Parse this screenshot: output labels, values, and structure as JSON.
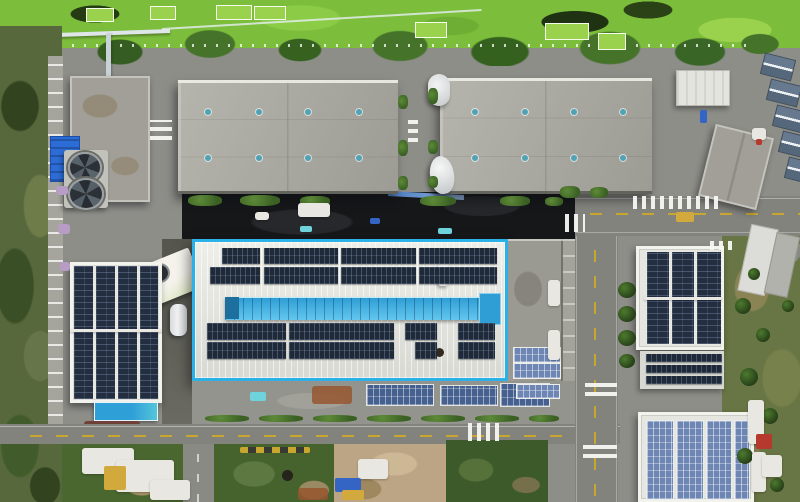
{
  "scene": {
    "type": "aerial-drone-photo",
    "subject": "industrial park with rooftop solar arrays, central plant outlined in cyan",
    "palette": {
      "pond_green": "#7cbd3c",
      "algae_green": "#9ad24e",
      "tree_green": "#3f6b28",
      "scrub_green": "#4a672f",
      "field_olive": "#687544",
      "dirt_tan": "#bca584",
      "pavement": "#8e8e89",
      "road": "#83837e",
      "asphalt_dark": "#151719",
      "warehouse_roof": "#aaaaa2",
      "roof_white": "#e7e7e2",
      "highlight_cyan": "#2ab2e8",
      "skylight_blue": "#3fa9dc",
      "solar_dark": "#1f2937",
      "solar_mid": "#46618f",
      "solar_light": "#6d86b4",
      "panel_column": "#232e40",
      "tarp_blue": "#2c6cd6",
      "canopy_blue": "#2f9fd8",
      "lane_yellow": "#c9a72e",
      "vent_teal": "#4fa3b5",
      "cabin_gray_blue": "#66798e"
    }
  },
  "elements": [
    {
      "name": "sports-court",
      "cls": "court",
      "x": 86,
      "y": 8,
      "w": 26,
      "h": 12
    },
    {
      "name": "sports-court",
      "cls": "court",
      "x": 150,
      "y": 6,
      "w": 24,
      "h": 12
    },
    {
      "name": "sports-court",
      "cls": "court",
      "x": 216,
      "y": 5,
      "w": 34,
      "h": 13
    },
    {
      "name": "sports-court",
      "cls": "court",
      "x": 254,
      "y": 6,
      "w": 30,
      "h": 12
    },
    {
      "name": "sports-court",
      "cls": "court",
      "x": 415,
      "y": 22,
      "w": 30,
      "h": 14
    },
    {
      "name": "sports-court",
      "cls": "court",
      "x": 545,
      "y": 23,
      "w": 42,
      "h": 15
    },
    {
      "name": "sports-court",
      "cls": "court",
      "x": 598,
      "y": 33,
      "w": 26,
      "h": 15
    },
    {
      "name": "roof-vent",
      "cls": "vent",
      "x": 205,
      "y": 109,
      "w": 6,
      "h": 6
    },
    {
      "name": "roof-vent",
      "cls": "vent",
      "x": 256,
      "y": 109,
      "w": 6,
      "h": 6
    },
    {
      "name": "roof-vent",
      "cls": "vent",
      "x": 305,
      "y": 109,
      "w": 6,
      "h": 6
    },
    {
      "name": "roof-vent",
      "cls": "vent",
      "x": 356,
      "y": 109,
      "w": 6,
      "h": 6
    },
    {
      "name": "roof-vent",
      "cls": "vent",
      "x": 205,
      "y": 155,
      "w": 6,
      "h": 6
    },
    {
      "name": "roof-vent",
      "cls": "vent",
      "x": 256,
      "y": 155,
      "w": 6,
      "h": 6
    },
    {
      "name": "roof-vent",
      "cls": "vent",
      "x": 305,
      "y": 155,
      "w": 6,
      "h": 6
    },
    {
      "name": "roof-vent",
      "cls": "vent",
      "x": 356,
      "y": 155,
      "w": 6,
      "h": 6
    },
    {
      "name": "roof-vent",
      "cls": "vent",
      "x": 472,
      "y": 109,
      "w": 6,
      "h": 6
    },
    {
      "name": "roof-vent",
      "cls": "vent",
      "x": 522,
      "y": 109,
      "w": 6,
      "h": 6
    },
    {
      "name": "roof-vent",
      "cls": "vent",
      "x": 571,
      "y": 109,
      "w": 6,
      "h": 6
    },
    {
      "name": "roof-vent",
      "cls": "vent",
      "x": 620,
      "y": 109,
      "w": 6,
      "h": 6
    },
    {
      "name": "roof-vent",
      "cls": "vent",
      "x": 472,
      "y": 155,
      "w": 6,
      "h": 6
    },
    {
      "name": "roof-vent",
      "cls": "vent",
      "x": 522,
      "y": 155,
      "w": 6,
      "h": 6
    },
    {
      "name": "roof-vent",
      "cls": "vent",
      "x": 571,
      "y": 155,
      "w": 6,
      "h": 6
    },
    {
      "name": "roof-vent",
      "cls": "vent",
      "x": 620,
      "y": 155,
      "w": 6,
      "h": 6
    },
    {
      "name": "rooftop-solar-array",
      "cls": "solar-dark",
      "x": 222,
      "y": 248,
      "w": 38,
      "h": 16
    },
    {
      "name": "rooftop-solar-array",
      "cls": "solar-dark",
      "x": 264,
      "y": 248,
      "w": 74,
      "h": 16
    },
    {
      "name": "rooftop-solar-array",
      "cls": "solar-dark",
      "x": 341,
      "y": 248,
      "w": 75,
      "h": 16
    },
    {
      "name": "rooftop-solar-array",
      "cls": "solar-dark",
      "x": 419,
      "y": 248,
      "w": 78,
      "h": 16
    },
    {
      "name": "rooftop-solar-array",
      "cls": "solar-dark",
      "x": 210,
      "y": 267,
      "w": 50,
      "h": 17
    },
    {
      "name": "rooftop-solar-array",
      "cls": "solar-dark",
      "x": 264,
      "y": 267,
      "w": 74,
      "h": 17
    },
    {
      "name": "rooftop-solar-array",
      "cls": "solar-dark",
      "x": 341,
      "y": 267,
      "w": 75,
      "h": 17
    },
    {
      "name": "rooftop-solar-array",
      "cls": "solar-dark",
      "x": 419,
      "y": 267,
      "w": 78,
      "h": 17
    },
    {
      "name": "rooftop-solar-array",
      "cls": "solar-dark",
      "x": 207,
      "y": 323,
      "w": 79,
      "h": 17
    },
    {
      "name": "rooftop-solar-array",
      "cls": "solar-dark",
      "x": 289,
      "y": 323,
      "w": 105,
      "h": 17
    },
    {
      "name": "rooftop-solar-array",
      "cls": "solar-dark",
      "x": 405,
      "y": 323,
      "w": 32,
      "h": 17
    },
    {
      "name": "rooftop-solar-array",
      "cls": "solar-dark",
      "x": 458,
      "y": 323,
      "w": 37,
      "h": 17
    },
    {
      "name": "rooftop-solar-array",
      "cls": "solar-dark",
      "x": 207,
      "y": 342,
      "w": 79,
      "h": 17
    },
    {
      "name": "rooftop-solar-array",
      "cls": "solar-dark",
      "x": 289,
      "y": 342,
      "w": 105,
      "h": 17
    },
    {
      "name": "rooftop-solar-array",
      "cls": "solar-dark",
      "x": 415,
      "y": 342,
      "w": 22,
      "h": 17
    },
    {
      "name": "rooftop-solar-array",
      "cls": "solar-dark",
      "x": 458,
      "y": 342,
      "w": 37,
      "h": 17
    },
    {
      "name": "solar-column",
      "cls": "solar-left",
      "x": 74,
      "y": 266,
      "w": 19,
      "h": 133
    },
    {
      "name": "solar-column",
      "cls": "solar-left",
      "x": 96,
      "y": 266,
      "w": 19,
      "h": 133
    },
    {
      "name": "solar-column",
      "cls": "solar-left",
      "x": 118,
      "y": 266,
      "w": 19,
      "h": 133
    },
    {
      "name": "solar-column",
      "cls": "solar-left",
      "x": 140,
      "y": 266,
      "w": 18,
      "h": 133
    },
    {
      "name": "roof-walkway",
      "cls": "clutter-white",
      "x": 70,
      "y": 329,
      "w": 92,
      "h": 3
    },
    {
      "name": "solar-column",
      "cls": "solar-left",
      "x": 647,
      "y": 252,
      "w": 22,
      "h": 92
    },
    {
      "name": "solar-column",
      "cls": "solar-left",
      "x": 672,
      "y": 252,
      "w": 22,
      "h": 92
    },
    {
      "name": "solar-column",
      "cls": "solar-left",
      "x": 697,
      "y": 252,
      "w": 24,
      "h": 92
    },
    {
      "name": "roof-walkway",
      "cls": "clutter-white",
      "x": 644,
      "y": 297,
      "w": 78,
      "h": 3
    },
    {
      "name": "solar-row",
      "cls": "solar-dark",
      "x": 646,
      "y": 354,
      "w": 76,
      "h": 8
    },
    {
      "name": "solar-row",
      "cls": "solar-dark",
      "x": 646,
      "y": 365,
      "w": 76,
      "h": 8
    },
    {
      "name": "solar-row",
      "cls": "solar-dark",
      "x": 646,
      "y": 376,
      "w": 76,
      "h": 8
    },
    {
      "name": "solar-column",
      "cls": "solar-light",
      "x": 646,
      "y": 420,
      "w": 26,
      "h": 78
    },
    {
      "name": "solar-column",
      "cls": "solar-light",
      "x": 676,
      "y": 420,
      "w": 26,
      "h": 78
    },
    {
      "name": "solar-column",
      "cls": "solar-light",
      "x": 706,
      "y": 420,
      "w": 24,
      "h": 78
    },
    {
      "name": "solar-column",
      "cls": "solar-light",
      "x": 734,
      "y": 420,
      "w": 14,
      "h": 78
    },
    {
      "name": "ground-solar-array",
      "cls": "solar-mid",
      "x": 366,
      "y": 384,
      "w": 66,
      "h": 20
    },
    {
      "name": "ground-solar-array",
      "cls": "solar-mid",
      "x": 440,
      "y": 385,
      "w": 56,
      "h": 19
    },
    {
      "name": "ground-solar-array",
      "cls": "solar-mid",
      "x": 500,
      "y": 383,
      "w": 48,
      "h": 22
    },
    {
      "name": "annex-solar-array",
      "cls": "solar-light",
      "x": 513,
      "y": 347,
      "w": 46,
      "h": 14
    },
    {
      "name": "annex-solar-array",
      "cls": "solar-light",
      "x": 513,
      "y": 363,
      "w": 46,
      "h": 14
    },
    {
      "name": "annex-solar-array",
      "cls": "solar-light",
      "x": 516,
      "y": 384,
      "w": 42,
      "h": 13
    },
    {
      "name": "crosswalk",
      "cls": "cw-v",
      "x": 633,
      "y": 196,
      "w": 86,
      "h": 13
    },
    {
      "name": "crosswalk",
      "cls": "cw-v",
      "x": 565,
      "y": 214,
      "w": 20,
      "h": 18
    },
    {
      "name": "crosswalk",
      "cls": "cw-h",
      "x": 150,
      "y": 120,
      "w": 22,
      "h": 20
    },
    {
      "name": "crosswalk",
      "cls": "cw-h",
      "x": 585,
      "y": 381,
      "w": 32,
      "h": 15
    },
    {
      "name": "crosswalk",
      "cls": "cw-h",
      "x": 583,
      "y": 443,
      "w": 34,
      "h": 15
    },
    {
      "name": "crosswalk",
      "cls": "cw-v",
      "x": 468,
      "y": 423,
      "w": 36,
      "h": 18
    },
    {
      "name": "crosswalk",
      "cls": "cw-v",
      "x": 710,
      "y": 241,
      "w": 24,
      "h": 9
    },
    {
      "name": "crosswalk",
      "cls": "cw-h",
      "x": 408,
      "y": 118,
      "w": 10,
      "h": 24
    },
    {
      "name": "cabin-roof",
      "cls": "cabin",
      "x": 762,
      "y": 56,
      "w": 30,
      "h": 20,
      "r": 14
    },
    {
      "name": "cabin-roof",
      "cls": "cabin",
      "x": 768,
      "y": 82,
      "w": 30,
      "h": 20,
      "r": 14
    },
    {
      "name": "cabin-roof",
      "cls": "cabin",
      "x": 774,
      "y": 108,
      "w": 30,
      "h": 20,
      "r": 14
    },
    {
      "name": "cabin-roof",
      "cls": "cabin",
      "x": 780,
      "y": 134,
      "w": 30,
      "h": 20,
      "r": 14
    },
    {
      "name": "cabin-roof",
      "cls": "cabin",
      "x": 786,
      "y": 160,
      "w": 30,
      "h": 20,
      "r": 14
    },
    {
      "name": "shed",
      "cls": "clutter-white",
      "x": 752,
      "y": 128,
      "w": 14,
      "h": 12
    },
    {
      "name": "shed-marker",
      "cls": "clutter-red",
      "x": 756,
      "y": 139,
      "w": 6,
      "h": 6
    },
    {
      "name": "hedge",
      "cls": "hedge",
      "x": 205,
      "y": 415,
      "w": 44,
      "h": 7
    },
    {
      "name": "hedge",
      "cls": "hedge",
      "x": 259,
      "y": 415,
      "w": 44,
      "h": 7
    },
    {
      "name": "hedge",
      "cls": "hedge",
      "x": 313,
      "y": 415,
      "w": 44,
      "h": 7
    },
    {
      "name": "hedge",
      "cls": "hedge",
      "x": 367,
      "y": 415,
      "w": 44,
      "h": 7
    },
    {
      "name": "hedge",
      "cls": "hedge",
      "x": 421,
      "y": 415,
      "w": 44,
      "h": 7
    },
    {
      "name": "hedge",
      "cls": "hedge",
      "x": 475,
      "y": 415,
      "w": 44,
      "h": 7
    },
    {
      "name": "hedge",
      "cls": "hedge",
      "x": 529,
      "y": 415,
      "w": 30,
      "h": 7
    },
    {
      "name": "hedge",
      "cls": "hedge",
      "x": 188,
      "y": 195,
      "w": 34,
      "h": 11
    },
    {
      "name": "hedge",
      "cls": "hedge",
      "x": 240,
      "y": 195,
      "w": 40,
      "h": 11
    },
    {
      "name": "hedge",
      "cls": "hedge",
      "x": 300,
      "y": 196,
      "w": 30,
      "h": 10
    },
    {
      "name": "hedge",
      "cls": "hedge",
      "x": 420,
      "y": 196,
      "w": 36,
      "h": 10
    },
    {
      "name": "hedge",
      "cls": "hedge",
      "x": 500,
      "y": 196,
      "w": 30,
      "h": 10
    },
    {
      "name": "hedge",
      "cls": "hedge",
      "x": 545,
      "y": 197,
      "w": 18,
      "h": 9
    },
    {
      "name": "hedge",
      "cls": "hedge",
      "x": 398,
      "y": 95,
      "w": 10,
      "h": 14
    },
    {
      "name": "hedge",
      "cls": "hedge",
      "x": 428,
      "y": 88,
      "w": 10,
      "h": 16
    },
    {
      "name": "hedge",
      "cls": "hedge",
      "x": 398,
      "y": 140,
      "w": 10,
      "h": 16
    },
    {
      "name": "hedge",
      "cls": "hedge",
      "x": 428,
      "y": 140,
      "w": 10,
      "h": 14
    },
    {
      "name": "hedge",
      "cls": "hedge",
      "x": 398,
      "y": 176,
      "w": 10,
      "h": 14
    },
    {
      "name": "hedge",
      "cls": "hedge",
      "x": 428,
      "y": 176,
      "w": 10,
      "h": 12
    },
    {
      "name": "hedge",
      "cls": "hedge",
      "x": 560,
      "y": 186,
      "w": 20,
      "h": 12
    },
    {
      "name": "hedge",
      "cls": "hedge",
      "x": 590,
      "y": 187,
      "w": 18,
      "h": 11
    },
    {
      "name": "tree",
      "cls": "tree",
      "x": 618,
      "y": 282,
      "w": 18,
      "h": 16
    },
    {
      "name": "tree",
      "cls": "tree",
      "x": 618,
      "y": 306,
      "w": 18,
      "h": 16
    },
    {
      "name": "tree",
      "cls": "tree",
      "x": 618,
      "y": 330,
      "w": 18,
      "h": 16
    },
    {
      "name": "tree",
      "cls": "tree",
      "x": 619,
      "y": 354,
      "w": 16,
      "h": 14
    },
    {
      "name": "tree",
      "cls": "tree",
      "x": 735,
      "y": 298,
      "w": 16,
      "h": 16
    },
    {
      "name": "tree",
      "cls": "tree",
      "x": 756,
      "y": 328,
      "w": 14,
      "h": 14
    },
    {
      "name": "tree",
      "cls": "tree",
      "x": 740,
      "y": 368,
      "w": 18,
      "h": 18
    },
    {
      "name": "tree",
      "cls": "tree",
      "x": 762,
      "y": 408,
      "w": 16,
      "h": 16
    },
    {
      "name": "tree",
      "cls": "tree",
      "x": 737,
      "y": 448,
      "w": 16,
      "h": 16
    },
    {
      "name": "tree",
      "cls": "tree",
      "x": 770,
      "y": 478,
      "w": 14,
      "h": 14
    },
    {
      "name": "tree",
      "cls": "tree",
      "x": 748,
      "y": 268,
      "w": 12,
      "h": 12
    },
    {
      "name": "tree",
      "cls": "tree",
      "x": 782,
      "y": 300,
      "w": 12,
      "h": 12
    },
    {
      "name": "tarp",
      "cls": "clutter-white",
      "x": 298,
      "y": 203,
      "w": 32,
      "h": 14
    },
    {
      "name": "tarp",
      "cls": "clutter-white",
      "x": 255,
      "y": 212,
      "w": 14,
      "h": 8
    },
    {
      "name": "debris",
      "cls": "clutter-teal",
      "x": 300,
      "y": 226,
      "w": 12,
      "h": 6
    },
    {
      "name": "debris",
      "cls": "clutter-teal",
      "x": 438,
      "y": 228,
      "w": 14,
      "h": 6
    },
    {
      "name": "debris",
      "cls": "clutter-blue",
      "x": 370,
      "y": 218,
      "w": 10,
      "h": 6
    },
    {
      "name": "debris",
      "cls": "clutter-purple",
      "x": 56,
      "y": 186,
      "w": 12,
      "h": 9
    },
    {
      "name": "debris",
      "cls": "clutter-purple",
      "x": 58,
      "y": 224,
      "w": 12,
      "h": 10
    },
    {
      "name": "debris",
      "cls": "clutter-purple",
      "x": 60,
      "y": 262,
      "w": 10,
      "h": 9
    },
    {
      "name": "tarp",
      "cls": "clutter-white",
      "x": 82,
      "y": 448,
      "w": 52,
      "h": 26
    },
    {
      "name": "tarp",
      "cls": "clutter-white",
      "x": 116,
      "y": 460,
      "w": 58,
      "h": 32
    },
    {
      "name": "tarp",
      "cls": "clutter-white",
      "x": 150,
      "y": 480,
      "w": 40,
      "h": 20
    },
    {
      "name": "hut",
      "cls": "clutter-yellow",
      "x": 104,
      "y": 466,
      "w": 22,
      "h": 24
    },
    {
      "name": "tarp",
      "cls": "clutter-white",
      "x": 358,
      "y": 459,
      "w": 30,
      "h": 20
    },
    {
      "name": "debris",
      "cls": "clutter-blue",
      "x": 335,
      "y": 478,
      "w": 26,
      "h": 14
    },
    {
      "name": "debris",
      "cls": "clutter-yellow",
      "x": 342,
      "y": 490,
      "w": 22,
      "h": 10
    },
    {
      "name": "barrel",
      "cls": "clutter-dark",
      "x": 282,
      "y": 470,
      "w": 11,
      "h": 11
    },
    {
      "name": "debris",
      "cls": "clutter-rust",
      "x": 298,
      "y": 488,
      "w": 30,
      "h": 12
    },
    {
      "name": "debris",
      "cls": "clutter-rust",
      "x": 312,
      "y": 386,
      "w": 40,
      "h": 18
    },
    {
      "name": "pool",
      "cls": "clutter-teal",
      "x": 250,
      "y": 392,
      "w": 16,
      "h": 9
    },
    {
      "name": "excavator",
      "cls": "clutter-yellow",
      "x": 676,
      "y": 212,
      "w": 18,
      "h": 10
    },
    {
      "name": "car",
      "cls": "clutter-blue",
      "x": 700,
      "y": 110,
      "w": 7,
      "h": 13
    },
    {
      "name": "boat",
      "cls": "clutter-white",
      "x": 748,
      "y": 400,
      "w": 16,
      "h": 44
    },
    {
      "name": "boat",
      "cls": "clutter-white",
      "x": 752,
      "y": 452,
      "w": 14,
      "h": 40
    },
    {
      "name": "container",
      "cls": "clutter-red",
      "x": 756,
      "y": 434,
      "w": 16,
      "h": 15
    },
    {
      "name": "tarp",
      "cls": "clutter-white",
      "x": 762,
      "y": 455,
      "w": 20,
      "h": 22
    },
    {
      "name": "ac-unit",
      "cls": "clutter-white",
      "x": 548,
      "y": 280,
      "w": 12,
      "h": 26
    },
    {
      "name": "ac-unit",
      "cls": "clutter-white",
      "x": 548,
      "y": 330,
      "w": 12,
      "h": 30
    }
  ]
}
